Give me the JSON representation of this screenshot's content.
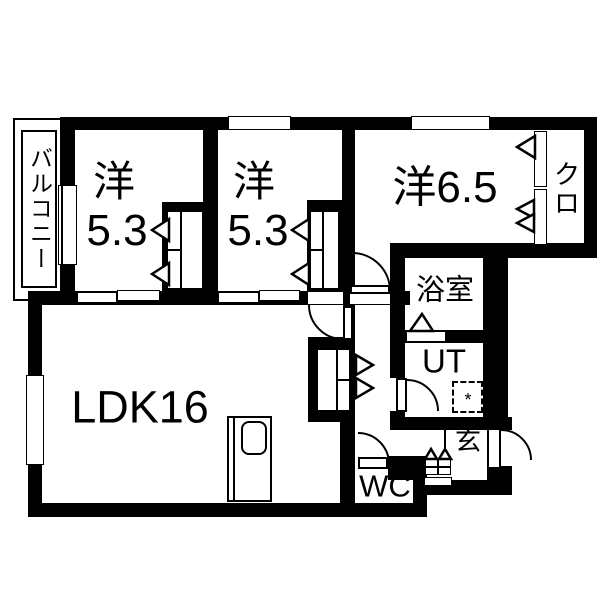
{
  "colors": {
    "wall": "#000000",
    "floor": "#ffffff"
  },
  "rooms": {
    "balcony": {
      "label": "バルコニー"
    },
    "bedroom1": {
      "label": "洋",
      "size": "5.3"
    },
    "bedroom2": {
      "label": "洋",
      "size": "5.3"
    },
    "bedroom3": {
      "label": "洋6.5"
    },
    "closet": {
      "label": "クロ"
    },
    "bathroom": {
      "label": "浴室"
    },
    "utility": {
      "label": "UT",
      "washer_mark": "*"
    },
    "ldk": {
      "label": "LDK16"
    },
    "entrance": {
      "label": "玄"
    },
    "wc": {
      "label": "WC"
    }
  }
}
